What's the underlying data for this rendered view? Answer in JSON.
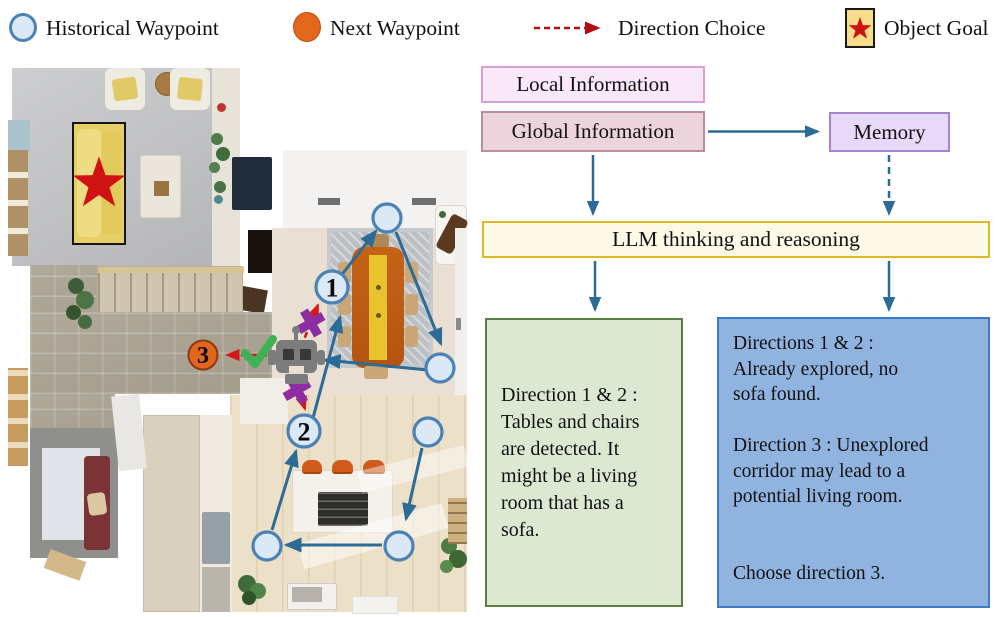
{
  "legend": {
    "historical_waypoint": "Historical Waypoint",
    "next_waypoint": "Next Waypoint",
    "direction_choice": "Direction Choice",
    "object_goal": "Object Goal"
  },
  "flowchart": {
    "local_information": "Local Information",
    "global_information": "Global Information",
    "memory": "Memory",
    "llm": "LLM thinking and reasoning",
    "observation_box": "Direction 1 & 2 :\nTables and chairs\nare detected. It\nmight be a living\nroom that has a\nsofa.",
    "reasoning_box": "Directions 1 & 2 :\nAlready explored, no\nsofa found.\n\nDirection 3 : Unexplored\ncorridor may lead to a\npotential living room.\n\n\nChoose direction 3."
  },
  "map": {
    "waypoint_1": "1",
    "waypoint_2": "2",
    "waypoint_3": "3"
  },
  "colors": {
    "path_arrow": "#2b6b95",
    "direction_arrow": "#d61717",
    "legend_arrow": "#b40f0f",
    "waypoint_fill": "#dbe8f6",
    "waypoint_stroke": "#4b82b4",
    "next_waypoint_fill": "#e2661c",
    "next_waypoint_stroke": "#8a3a10",
    "goal_star": "#cf1313",
    "goal_box_fill": "#f7dd8c",
    "blocked_x": "#8e2da0",
    "check": "#3cb254",
    "robot": "#7c7c7c",
    "local_fill": "#f9e8f9",
    "local_border": "#db9ed3",
    "global_fill": "#ecd4dc",
    "global_border": "#bb8ba1",
    "memory_fill": "#e9d9f8",
    "memory_border": "#a583d1",
    "llm_fill": "#fdf9e7",
    "llm_border": "#dfb827",
    "observation_fill": "#dde8d3",
    "observation_border": "#597f42",
    "reasoning_fill": "#91b3e0",
    "reasoning_border": "#3d7cc2"
  }
}
